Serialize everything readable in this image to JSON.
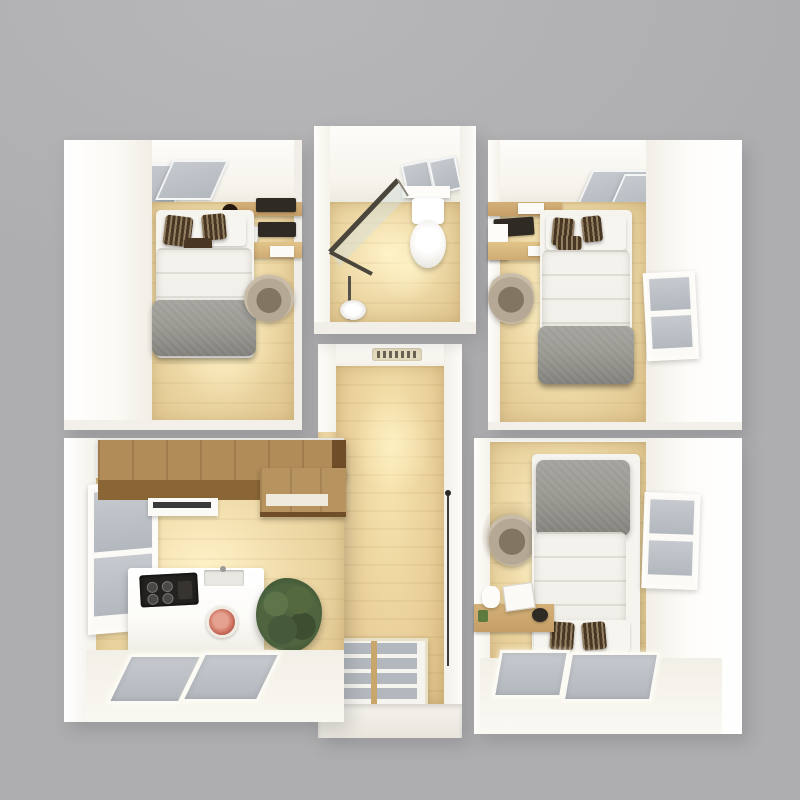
{
  "scene": {
    "title": "3D top-down architectural render of a small modular home floor plan on a gray background",
    "style": "photoreal top-down dollhouse view, warm interior lighting",
    "background": "#aeaeb0"
  },
  "palette": {
    "bg": "#aeaeb0",
    "wall": "#f8f6f1",
    "wall-dim": "#ece8e0",
    "ceiling": "#f7f4ed",
    "floor-bright": "#fff2c8",
    "floor-wood": "#eed9a6",
    "floor-dim": "#ddc18a",
    "hall-floor": "#ead09a",
    "pane": "#b3b8be",
    "pane-hi": "#c6cacf",
    "duvet": "#f1efe9",
    "blanket": "#97968f",
    "blanket-dark": "#807f7a",
    "pillow-dark": "#4a3723",
    "chair-light": "#b5a996",
    "chair-dark": "#837661",
    "cabinet-top": "#b18c58",
    "cabinet-front": "#8a6636",
    "cabinet-dark": "#6e4d28",
    "desk-wood": "#c49e66",
    "counter": "#fcfbf8",
    "cooktop": "#24221f",
    "plate": "#cc6f5e",
    "plant": "#4e6540",
    "plant-dark": "#334628",
    "door-frame": "#e9e0c8",
    "door-mullion": "#c9a76c",
    "vent-bg": "#e6dcbf",
    "vent-dark": "#6b6354",
    "line-dark": "#3c3a36",
    "glass": "rgba(214,223,220,0.5)"
  },
  "rooms": [
    {
      "name": "bedroom-top-left",
      "furniture": [
        "double-bed",
        "gray-throw-blanket",
        "dark-patterned-pillows",
        "wall-shelf",
        "desk-with-laptop",
        "office-chair",
        "two-ceiling-skylights",
        "warm-floor-lamp-glow"
      ]
    },
    {
      "name": "bathroom",
      "furniture": [
        "toilet",
        "corner-glass-shower",
        "floor-drain",
        "towel-shelf",
        "two-skylight-panes"
      ]
    },
    {
      "name": "bedroom-top-right",
      "furniture": [
        "double-bed",
        "gray-throw-blanket",
        "dark-patterned-pillows",
        "wall-shelf",
        "desk-with-laptop",
        "mini-fridge",
        "office-chair",
        "side-wall-window",
        "two-ceiling-skylights"
      ]
    },
    {
      "name": "hallway",
      "furniture": [
        "air-vent-grille",
        "sliding-door-edge",
        "glazed-entry-door-8-panes",
        "white-threshold"
      ]
    },
    {
      "name": "kitchen-living",
      "furniture": [
        "upper-wood-cabinets",
        "peninsula-counter",
        "range-hood-shelf",
        "black-cooktop",
        "white-counter",
        "decor-plate",
        "potted-plant",
        "left-wall-window",
        "two-floor-skylights"
      ]
    },
    {
      "name": "bedroom-bottom-right",
      "furniture": [
        "double-bed",
        "gray-throw-blanket",
        "dark-patterned-pillows",
        "lounge-chair-in-alcove",
        "desk-with-lamp-and-laptop",
        "side-wall-window",
        "two-floor-skylights"
      ]
    }
  ]
}
